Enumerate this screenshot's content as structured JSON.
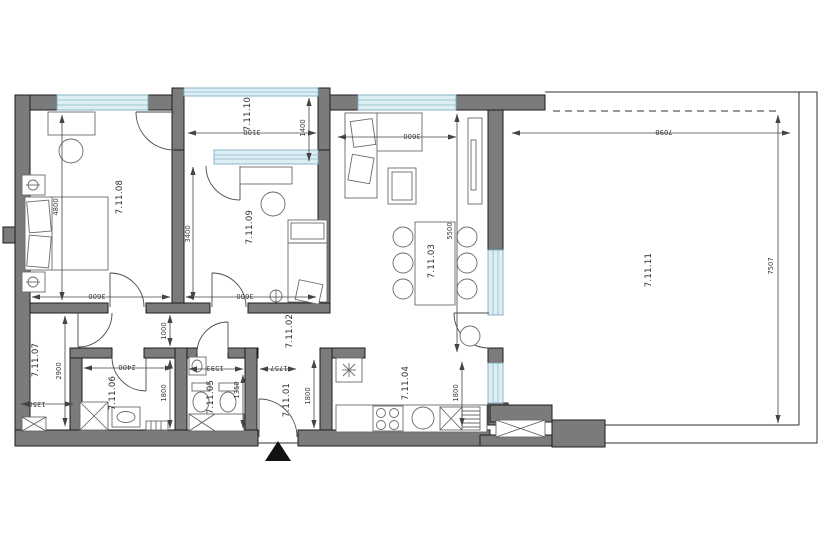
{
  "plan": {
    "rooms": {
      "entry": {
        "label": "7.11.01"
      },
      "hall": {
        "label": "7.11.02"
      },
      "living": {
        "label": "7.11.03"
      },
      "kitchen": {
        "label": "7.11.04"
      },
      "wc": {
        "label": "7.11.05"
      },
      "bathroom": {
        "label": "7.11.06"
      },
      "corridor": {
        "label": "7.11.07"
      },
      "bedroom1": {
        "label": "7.11.08"
      },
      "bedroom2": {
        "label": "7.11.09"
      },
      "loggia": {
        "label": "7.11.10"
      },
      "terrace": {
        "label": "7.11.11"
      }
    },
    "dims": {
      "bedroom1_height": "4800",
      "bedroom1_width": "3600",
      "bedroom2_height": "3400",
      "bedroom2_width": "3600",
      "loggia_width": "3100",
      "loggia_depth": "1400",
      "living_width": "3600",
      "living_height": "5500",
      "terrace_width": "7098",
      "terrace_height": "7507",
      "hall_width": "1000",
      "corridor_height": "2900",
      "corridor_width": "1350",
      "bathroom_width": "2400",
      "bathroom_height": "1800",
      "wc_width": "1593",
      "wc_height": "1350",
      "entry_width": "1757",
      "entry_height": "1800",
      "kitchen_height": "1800"
    },
    "colors": {
      "wall": "#7b7b7b",
      "window": "#ddeef4",
      "line": "#3c3c3c",
      "entrance_marker": "#111111"
    }
  }
}
